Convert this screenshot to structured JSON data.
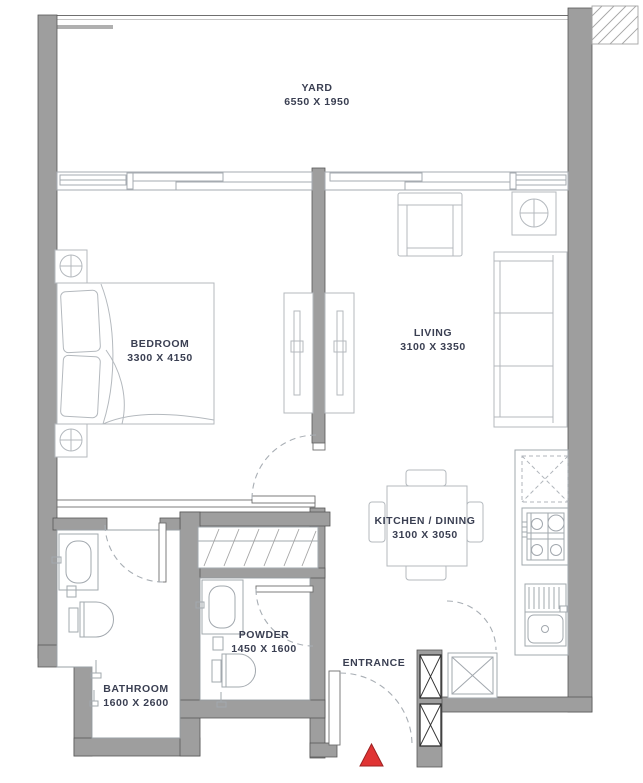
{
  "plan": {
    "rooms": {
      "yard": {
        "label": "YARD",
        "dims": "6550 X 1950"
      },
      "bedroom": {
        "label": "BEDROOM",
        "dims": "3300 X 4150"
      },
      "living": {
        "label": "LIVING",
        "dims": "3100 X 3350"
      },
      "kitchen_dining": {
        "label": "KITCHEN / DINING",
        "dims": "3100 X 3050"
      },
      "bathroom": {
        "label": "BATHROOM",
        "dims": "1600 X 2600"
      },
      "powder": {
        "label": "POWDER",
        "dims": "1450 X 1600"
      }
    },
    "entrance": {
      "label": "ENTRANCE",
      "marker": "red-triangle"
    },
    "colors": {
      "wall": "#9e9e9e",
      "furniture_line": "#b4b9be",
      "text": "#3a3f52",
      "marker": "#e03434",
      "background": "#ffffff"
    }
  }
}
